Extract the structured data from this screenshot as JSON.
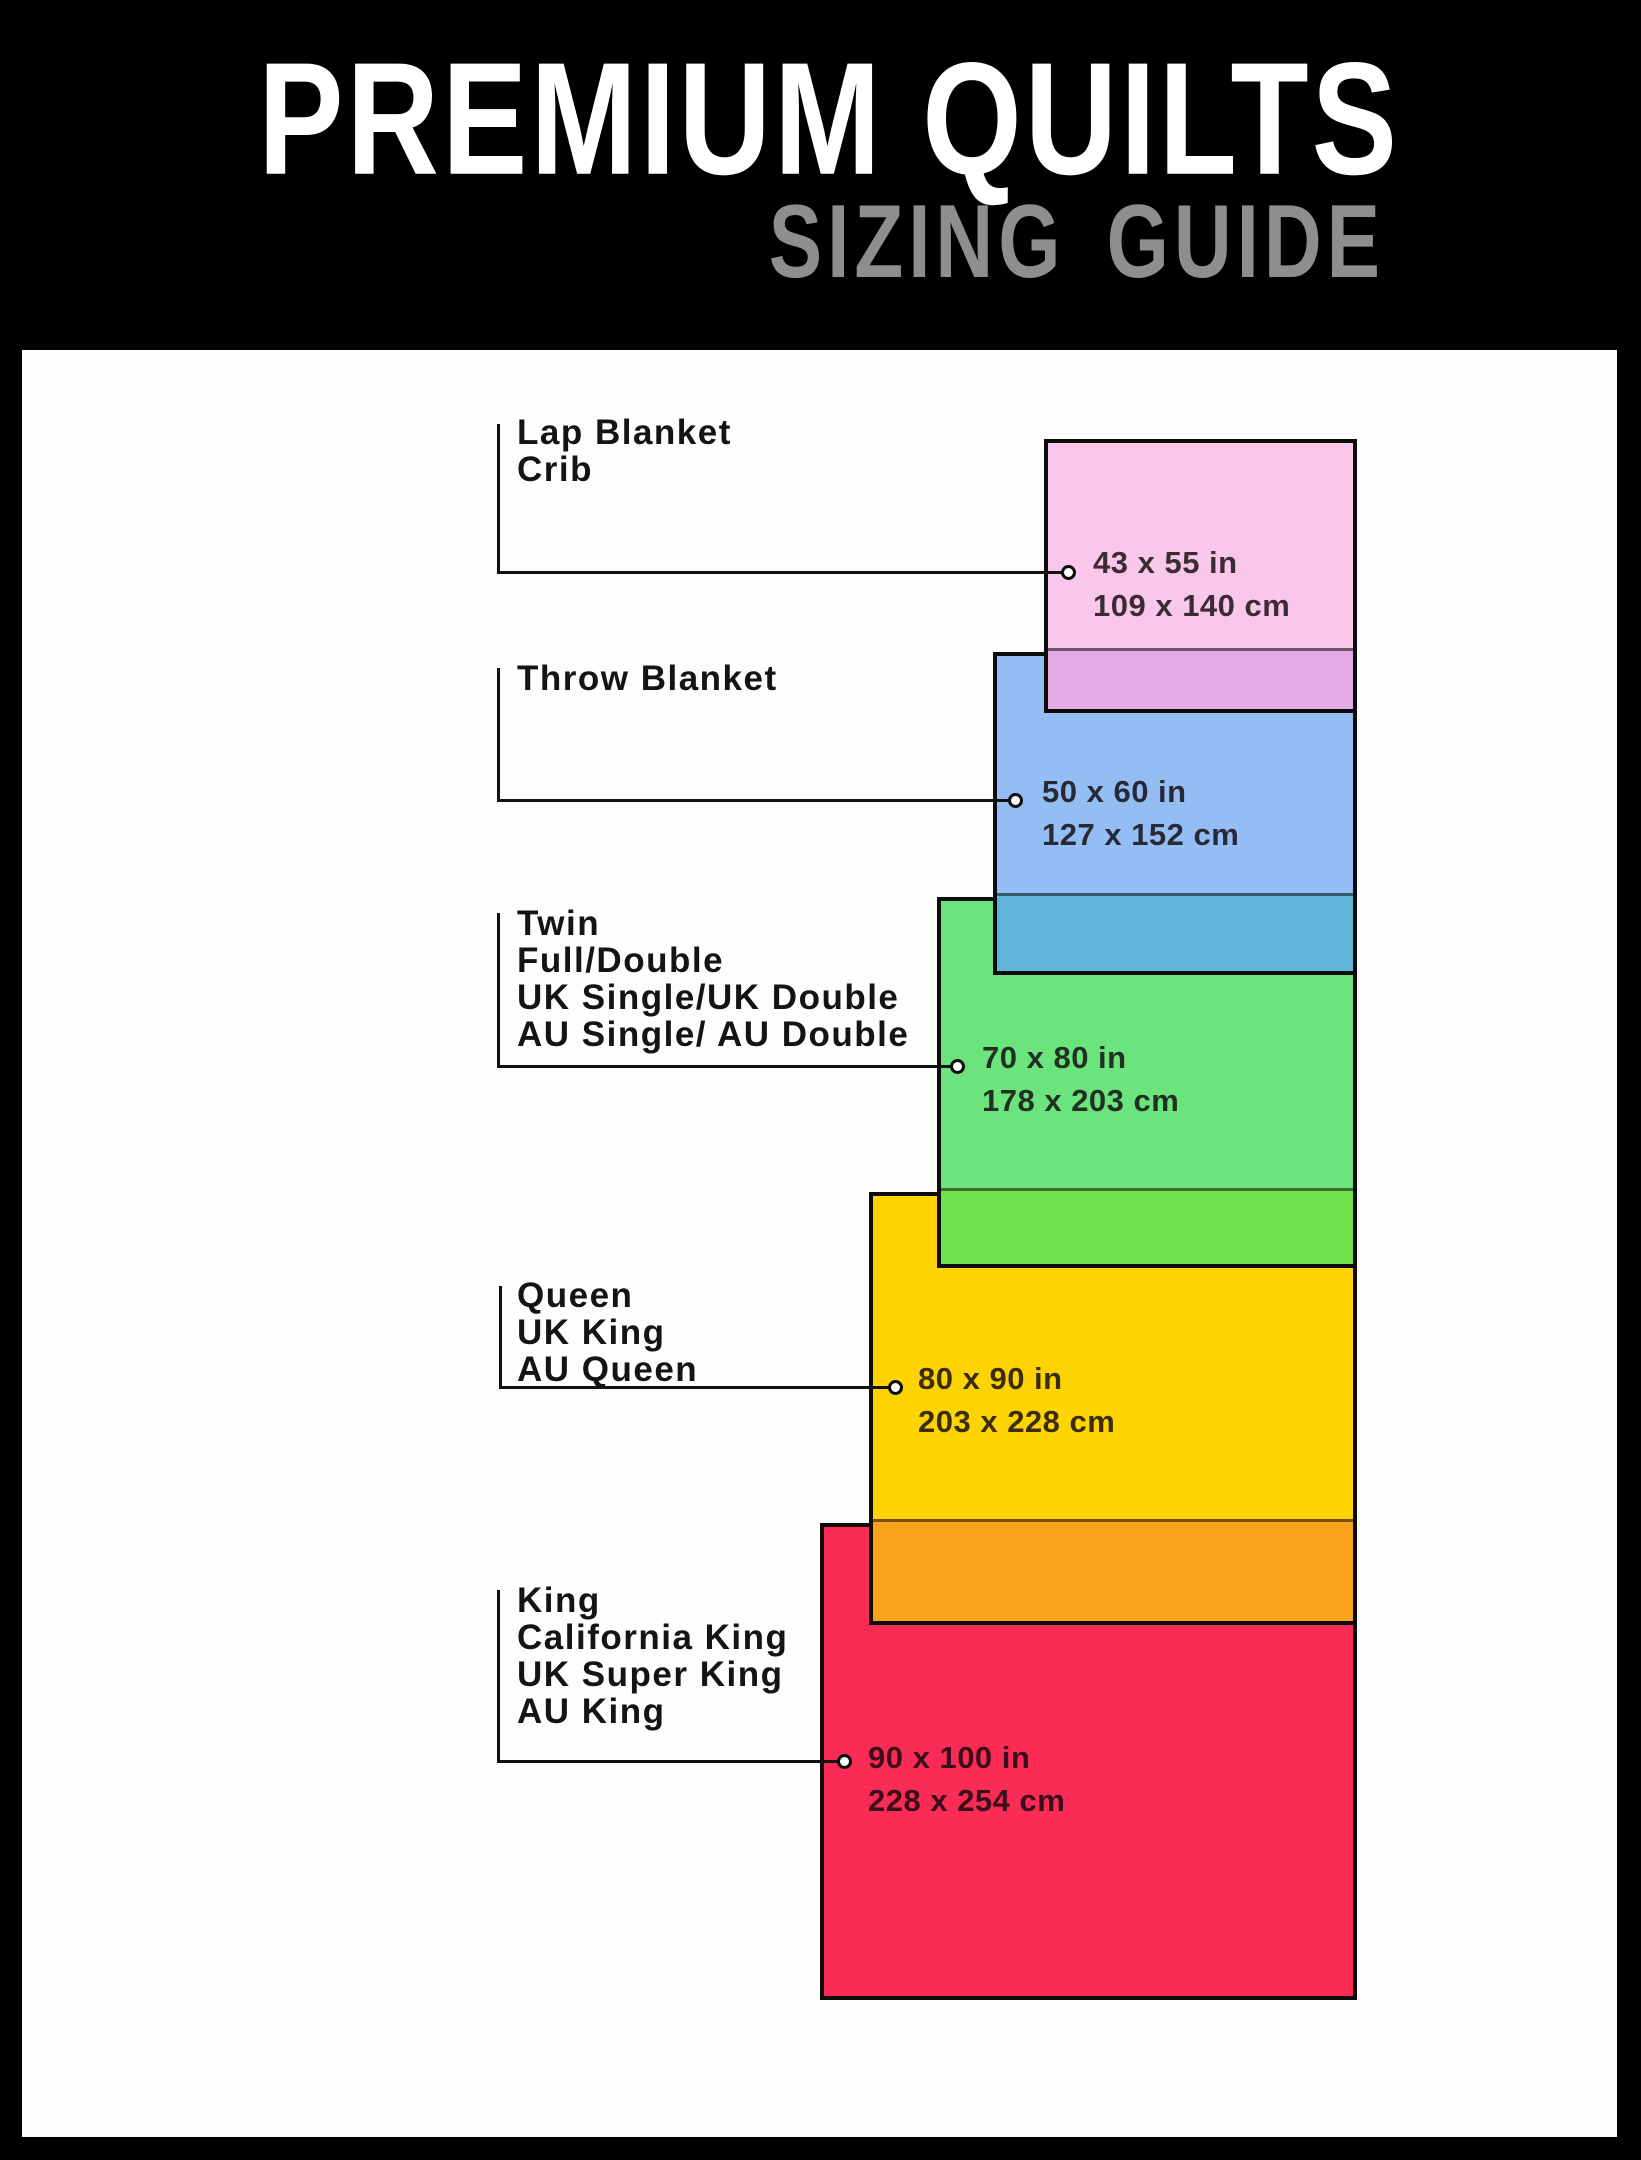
{
  "header": {
    "title": "PREMIUM QUILTS",
    "subtitle": "SIZING GUIDE",
    "title_color": "#ffffff",
    "subtitle_color": "#8e8e8e",
    "background": "#000000"
  },
  "panel_background": "#fdfdfd",
  "sizes": [
    {
      "labels": [
        "Lap Blanket",
        "Crib"
      ],
      "inches": "43 x 55 in",
      "cm": "109 x 140 cm",
      "color": "#f9c7e9",
      "overlap_color": "#e5abe5"
    },
    {
      "labels": [
        "Throw Blanket"
      ],
      "inches": "50 x 60 in",
      "cm": "127 x 152 cm",
      "color": "#93bdf3",
      "overlap_color": "#5fb6da"
    },
    {
      "labels": [
        "Twin",
        "Full/Double",
        "UK Single/UK Double",
        "AU Single/ AU Double"
      ],
      "inches": "70 x 80 in",
      "cm": "178 x 203 cm",
      "color": "#6ce47e",
      "overlap_color": "#70e24b"
    },
    {
      "labels": [
        "Queen",
        "UK King",
        "AU Queen"
      ],
      "inches": "80 x 90 in",
      "cm": "203 x 228 cm",
      "color": "#fdd402",
      "overlap_color": "#f8a31a"
    },
    {
      "labels": [
        "King",
        "California King",
        "UK Super King",
        "AU King"
      ],
      "inches": "90 x 100 in",
      "cm": "228 x 254 cm",
      "color": "#fa2b55",
      "overlap_color": null
    }
  ]
}
